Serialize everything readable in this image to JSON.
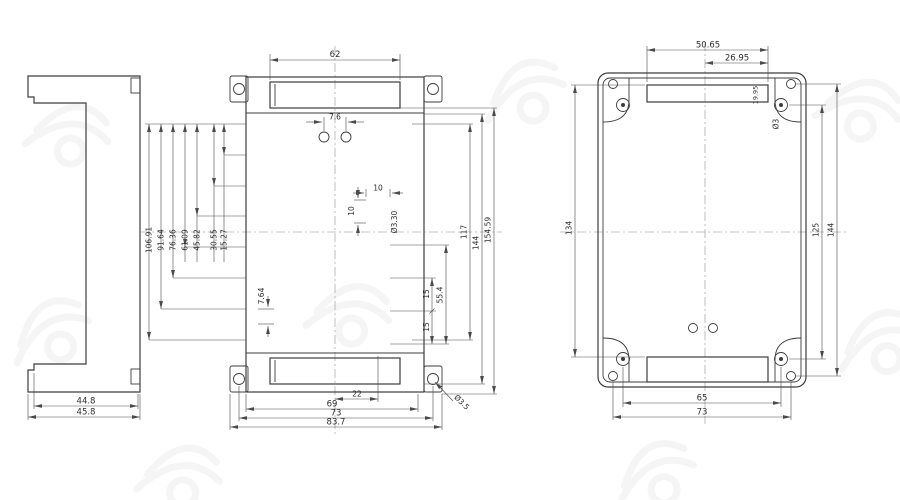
{
  "views": {
    "side": {
      "dims": {
        "width_inner": "44.8",
        "width_outer": "45.8"
      }
    },
    "front": {
      "dims": {
        "top_slot_width": "62",
        "top_hole_pair_spacing": "7.6",
        "pitch_1": "15.27",
        "pitch_2": "30.55",
        "pitch_3": "45.82",
        "pitch_4": "61.09",
        "pitch_5": "76.36",
        "pitch_6": "91.64",
        "pitch_7": "106.91",
        "bottom_hole_pitch": "7.64",
        "square_width": "10",
        "square_height": "10",
        "terminal_hole_dia": "Ø3.30",
        "square_pitch_a": "15",
        "square_pitch_b": "15",
        "square_span": "55.4",
        "holes_span": "117",
        "body_height": "144",
        "total_height": "154.59",
        "bottom_offset": "22",
        "bottom_span_a": "69",
        "bottom_span_b": "73",
        "bottom_span_c": "83.7",
        "mount_hole_dia": "Ø3.5"
      }
    },
    "back": {
      "dims": {
        "slot_width": "50.65",
        "slot_half_width": "26.95",
        "slot_note": "19.95",
        "screw_hole_dia": "Ø3",
        "left_height": "134",
        "screw_span_v": "125",
        "corner_hole_span_v": "144",
        "screw_span_h": "65",
        "corner_hole_span_h": "73"
      }
    }
  }
}
